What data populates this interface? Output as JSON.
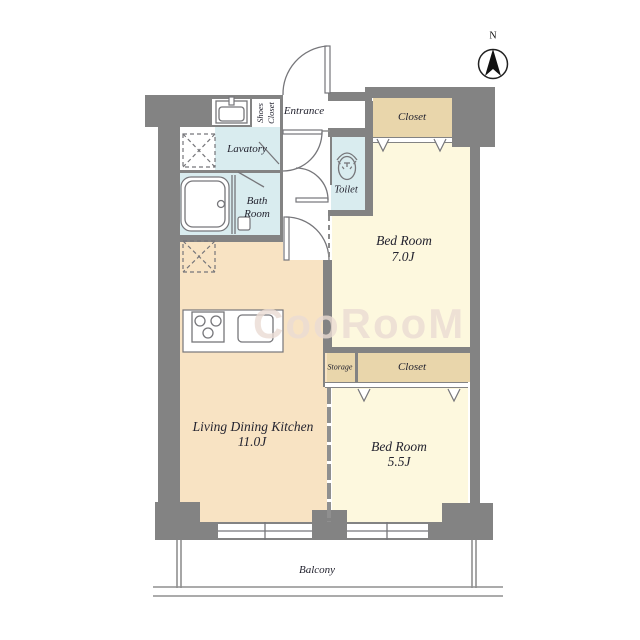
{
  "palette": {
    "wall": "#838383",
    "ink": "#23232f",
    "water": "#d9ecef",
    "ldk": "#f8e3c3",
    "bedroom": "#fdf8de",
    "closet": "#e9d6ab",
    "line": "#76767a",
    "bline": "#8f8f8f",
    "wm": "#ebdcd4"
  },
  "compass": {
    "label": "N"
  },
  "watermark": {
    "text": "CooRooM"
  },
  "rooms": {
    "entrance": {
      "label": "Entrance"
    },
    "shoes_closet": {
      "word1": "Shoes",
      "word2": "Closet"
    },
    "lavatory": {
      "label": "Lavatory"
    },
    "bath_room": {
      "line1": "Bath",
      "line2": "Room"
    },
    "toilet": {
      "label": "Toilet"
    },
    "closet_north": {
      "label": "Closet"
    },
    "bedroom_north": {
      "name": "Bed Room",
      "size": "7.0J"
    },
    "storage": {
      "label": "Storage"
    },
    "closet_south": {
      "label": "Closet"
    },
    "bedroom_south": {
      "name": "Bed Room",
      "size": "5.5J"
    },
    "living_dining_kitchen": {
      "name": "Living Dining Kitchen",
      "size": "11.0J"
    },
    "balcony": {
      "label": "Balcony"
    }
  }
}
